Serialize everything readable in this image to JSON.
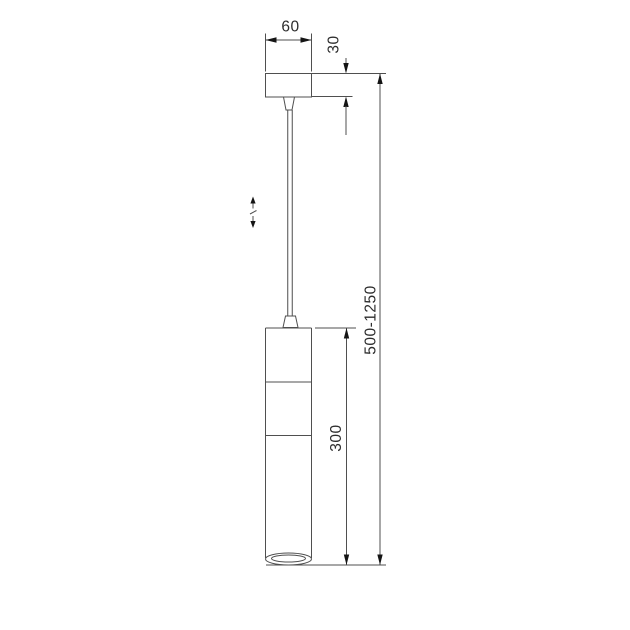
{
  "colors": {
    "line": "#4f4f4f",
    "arrow": "#141414",
    "text": "#2d2d2d",
    "background": "#ffffff"
  },
  "drawing": {
    "subject": "pendant lamp suspension - dimensional technical drawing",
    "dimensions": {
      "canopy_width": "60",
      "canopy_height": "30",
      "body_height": "300",
      "overall_height": "500-1250"
    },
    "symbols": {
      "height_adjustable": "adjustable suspension height (up/down arrows with break mark)"
    }
  }
}
